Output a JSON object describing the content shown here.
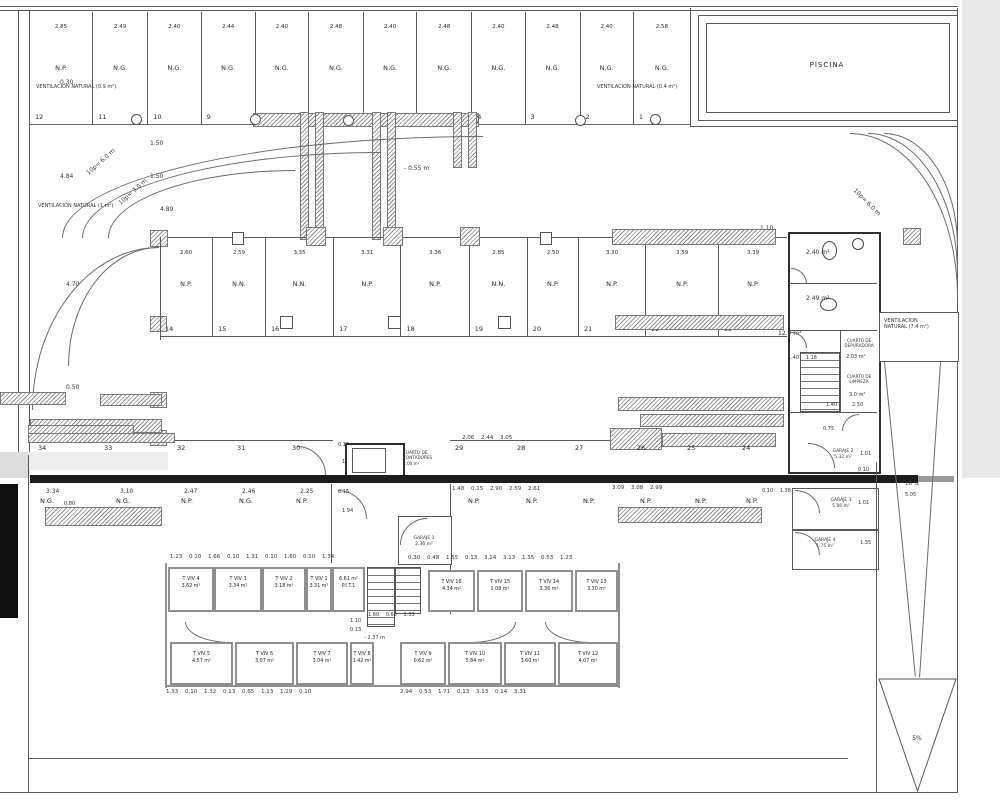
{
  "piscina": {
    "label": "PISCINA"
  },
  "top_row": {
    "vent_left": "VENTILACION NATURAL (0.9 m²)",
    "vent_right": "VENTILACION NATURAL (0.4 m²)",
    "wall_dim": "0.30",
    "spaces": [
      {
        "n": "12",
        "label": "N.P.",
        "dim": "2.85"
      },
      {
        "n": "11",
        "label": "N.G.",
        "dim": "2.49"
      },
      {
        "n": "10",
        "label": "N.G.",
        "dim": "2.40"
      },
      {
        "n": "9",
        "label": "N.G.",
        "dim": "2.44"
      },
      {
        "n": "8",
        "label": "N.G.",
        "dim": "2.40"
      },
      {
        "n": "7",
        "label": "N.G.",
        "dim": "2.48"
      },
      {
        "n": "6",
        "label": "N.G.",
        "dim": "2.40"
      },
      {
        "n": "5",
        "label": "N.G.",
        "dim": "2.48"
      },
      {
        "n": "4",
        "label": "N.G.",
        "dim": "2.40"
      },
      {
        "n": "3",
        "label": "N.G.",
        "dim": "2.48"
      },
      {
        "n": "2",
        "label": "N.G.",
        "dim": "2.40"
      },
      {
        "n": "1",
        "label": "N.G.",
        "dim": "2.58"
      }
    ]
  },
  "ramp_left": {
    "slope_outer": "10p= 6.0 m",
    "slope_inner": "10p= 3.0 m",
    "vent": "VENTILACION NATURAL (1 m²)",
    "d1": "1.50",
    "d2": "1.50",
    "d3": "4.84",
    "d4": "4.89",
    "d5": "4.70",
    "d6": "0.50"
  },
  "aisle": {
    "level": "- 0.55 m",
    "d_right": "1.10"
  },
  "mid_row": {
    "spaces": [
      {
        "n": "14",
        "label": "N.P.",
        "dim": "2.60"
      },
      {
        "n": "15",
        "label": "N.N.",
        "dim": "2.59"
      },
      {
        "n": "16",
        "label": "N.N.",
        "dim": "3.35"
      },
      {
        "n": "17",
        "label": "N.P.",
        "dim": "3.31"
      },
      {
        "n": "18",
        "label": "N.P.",
        "dim": "3.36"
      },
      {
        "n": "19",
        "label": "N.N.",
        "dim": "2.85"
      },
      {
        "n": "20",
        "label": "N.P.",
        "dim": "2.50"
      },
      {
        "n": "21",
        "label": "N.P.",
        "dim": "3.30"
      },
      {
        "n": "22",
        "label": "N.P.",
        "dim": "3.59"
      },
      {
        "n": "23",
        "label": "N.P.",
        "dim": "3.39"
      }
    ]
  },
  "row3": {
    "numbers": [
      "34",
      "33",
      "32",
      "31",
      "30",
      "29",
      "28",
      "27",
      "26",
      "25",
      "24"
    ],
    "dims": "2.06 2.44 3.05",
    "door_dims": [
      "0.15",
      "1.97",
      "0.15",
      "1.94"
    ]
  },
  "row4": {
    "left_dims": [
      "3.34",
      "3.10",
      "2.47",
      "2.46",
      "2.25"
    ],
    "left_extra": "0.80",
    "left_labels": [
      "N.G.",
      "N.G.",
      "N.P.",
      "N.G.",
      "N.P."
    ],
    "right_dims_a": "1.48 0.15 2.90 2.59 2.61",
    "right_dims_b": "3.09 3.08 2.99",
    "right_dims_c": "0.10 1.38 0.50",
    "right_labels": [
      "N.P.",
      "N.P.",
      "N.P.",
      "N.P.",
      "N.P.",
      "N.P."
    ]
  },
  "ramp_right": {
    "slope": "10p= 6.0 m",
    "d1": "5.10",
    "d2": "1.77"
  },
  "rooms_right": {
    "bath1_area": "2.40 m²",
    "bath2_area": "2.49 m²",
    "stair_area": "12.0 m²",
    "depuradora": [
      "CUARTO DE",
      "DEPURADORA"
    ],
    "depuradora_area": "2.03 m²",
    "limpieza": [
      "CUARTO DE",
      "LIMPIEZA"
    ],
    "limpieza_area": "3.0 m²",
    "dims_top": "1.40 1.18",
    "d_mid": "1.40",
    "d_mid2": "2.50",
    "d_low": "0.75",
    "d_s1": "0.10",
    "d_s2": "0.10"
  },
  "vent74": [
    "VENTILACION",
    "NATURAL (7.4 m²)"
  ],
  "center_core": {
    "cuarto": [
      "CUARTO DE",
      "CONTADORES"
    ],
    "cuarto_area": "2.00 m²"
  },
  "garajes": {
    "g1": {
      "name": "GARAJE 1",
      "area": "2.36 m²"
    },
    "g2": {
      "name": "GARAJE 2",
      "area": "5.32 m²",
      "dim": "1.01"
    },
    "g3": {
      "name": "GARAJE 3",
      "area": "5.00 m²",
      "dim": "1.01"
    },
    "g4": {
      "name": "GARAJE 4",
      "area": "1.75 m²",
      "dim": "1.35"
    }
  },
  "slopes": {
    "ramp16": "16 %",
    "ramp16_dim": "5.05",
    "ramp5": "5%"
  },
  "trasteros": {
    "upper": [
      {
        "name": "T VIV 4",
        "area": "3.62 m²"
      },
      {
        "name": "T VIV 3",
        "area": "3.34 m²"
      },
      {
        "name": "T VIV 2",
        "area": "3.18 m²"
      },
      {
        "name": "T VIV 1",
        "area": "3.31 m²"
      }
    ],
    "pit": {
      "area": "6.61 m²",
      "name": "P.I.T.1"
    },
    "mid": [
      {
        "name": "T VIV 16",
        "area": "4.34 m²"
      },
      {
        "name": "T VIV 15",
        "area": "2.08 m²"
      },
      {
        "name": "T VIV 14",
        "area": "3.36 m²"
      },
      {
        "name": "T VIV 13",
        "area": "3.30 m²"
      }
    ],
    "lower": [
      {
        "name": "T VIV 5",
        "area": "4.57 m²"
      },
      {
        "name": "T VIV 6",
        "area": "3.07 m²"
      },
      {
        "name": "T VIV 7",
        "area": "3.04 m²"
      },
      {
        "name": "T VIV 8",
        "area": "1.42 m²"
      },
      {
        "name": "T VIV 9",
        "area": "0.62 m²"
      },
      {
        "name": "T VIV 10",
        "area": "5.84 m²"
      },
      {
        "name": "T VIV 11",
        "area": "3.60 m²"
      },
      {
        "name": "T VIV 12",
        "area": "4.07 m²"
      }
    ],
    "dims_upper_left": "1.23 0.10 1.66 0.10 1.31 0.10 1.60 0.10 1.34",
    "dims_upper_right": "0.30 0.48 1.55 0.13 3.14 3.13 1.35 0.53 1.23",
    "dims_lower_left": "1.33 0.10 1.32 0.13 0.65 1.13 1.29 0.10",
    "dims_lower_right": "2.94 0.53 1.71 0.13 3.13 0.14 3.31",
    "stair_dims": "1.60 0.68 1.33",
    "d1": "1.10",
    "d2": "0.13",
    "level": "- 2.37 m"
  }
}
